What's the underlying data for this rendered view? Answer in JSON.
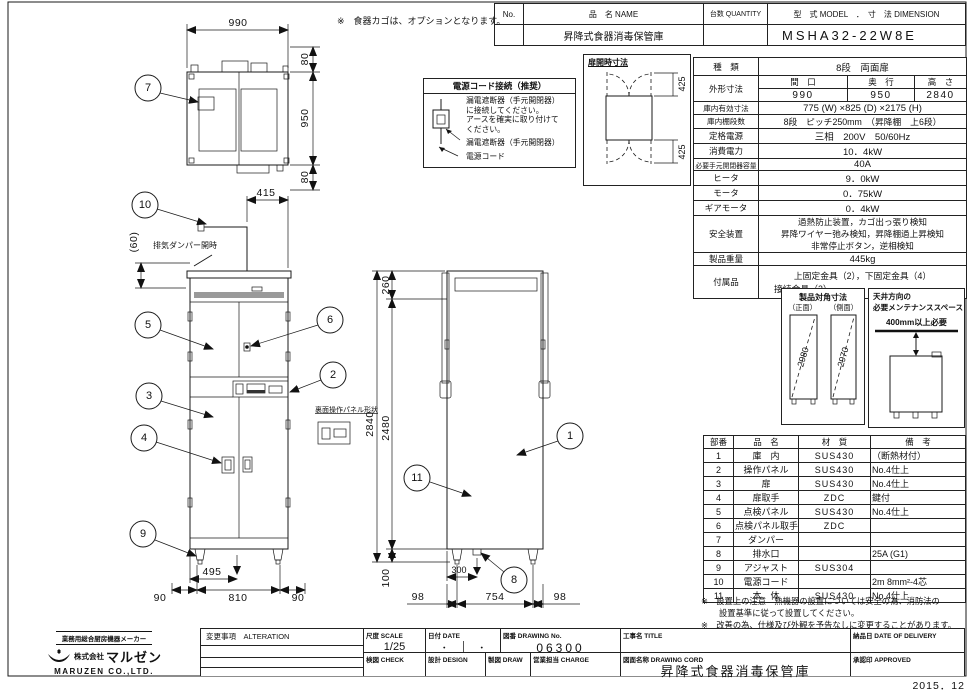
{
  "sheet": {
    "date_stamp": "2015．12"
  },
  "title_table": {
    "no_label": "No.",
    "name_label": "品　名 NAME",
    "qty_label": "台数 QUANTITY",
    "model_label": "型　式 MODEL　．　寸　法 DIMENSION",
    "product_name": "昇降式食器消毒保管庫",
    "model_value": "MSHA32-22W8E"
  },
  "option_note": "※　食器カゴは、オプションとなります。",
  "spec": {
    "kind_label": "種　類",
    "kind_value": "8段　両面扉",
    "outer_label": "外形寸法",
    "width_label": "間　口",
    "depth_label": "奥　行",
    "height_label": "高　さ",
    "width_value": "990",
    "depth_value": "950",
    "height_value": "2840",
    "inner_label": "庫内有効寸法",
    "inner_value": "775 (W) ×825 (D) ×2175 (H)",
    "shelf_label": "庫内棚段数",
    "shelf_value": "8段　ピッチ250mm　（昇降棚　上6段）",
    "power_label": "定格電源",
    "power_value": "三相　200V　50/60Hz",
    "consumption_label": "消費電力",
    "consumption_value": "10．4kW",
    "breaker_label": "必要手元開閉器容量",
    "breaker_value": "40A",
    "heater_label": "ヒータ",
    "heater_value": "9．0kW",
    "motor_label": "モータ",
    "motor_value": "0．75kW",
    "gear_label": "ギアモータ",
    "gear_value": "0．4kW",
    "safety_label": "安全装置",
    "safety_line1": "過熱防止装置，カゴ出っ張り検知",
    "safety_line2": "昇降ワイヤー弛み検知，昇降棚過上昇検知",
    "safety_line3": "非常停止ボタン，逆相検知",
    "weight_label": "製品重量",
    "weight_value": "445kg",
    "accessory_label": "付属品",
    "accessory_line1": "上固定金具（2），下固定金具（4）",
    "accessory_line2": "接続金具（2）"
  },
  "diagonal_box": {
    "title": "製品対角寸法",
    "front_label": "（正面）",
    "side_label": "（側面）",
    "front_value": "2980",
    "side_value": "2970"
  },
  "maintenance_box": {
    "title_line1": "天井方向の",
    "title_line2": "必要メンテナンススペース",
    "clearance": "400mm以上必要"
  },
  "parts": {
    "headers": {
      "no": "部番",
      "name": "品　名",
      "material": "材　質",
      "note": "備　考"
    },
    "rows": [
      {
        "no": "1",
        "name": "庫　内",
        "material": "SUS430",
        "note": "（断熱材付）"
      },
      {
        "no": "2",
        "name": "操作パネル",
        "material": "SUS430",
        "note": "No.4仕上"
      },
      {
        "no": "3",
        "name": "扉",
        "material": "SUS430",
        "note": "No.4仕上"
      },
      {
        "no": "4",
        "name": "扉取手",
        "material": "ZDC",
        "note": "鍵付"
      },
      {
        "no": "5",
        "name": "点検パネル",
        "material": "SUS430",
        "note": "No.4仕上"
      },
      {
        "no": "6",
        "name": "点検パネル取手",
        "material": "ZDC",
        "note": ""
      },
      {
        "no": "7",
        "name": "ダンパー",
        "material": "",
        "note": ""
      },
      {
        "no": "8",
        "name": "排水口",
        "material": "",
        "note": "25A (G1)"
      },
      {
        "no": "9",
        "name": "アジャスト",
        "material": "SUS304",
        "note": ""
      },
      {
        "no": "10",
        "name": "電源コード",
        "material": "",
        "note": "2m 8mm²-4芯"
      },
      {
        "no": "11",
        "name": "本　体",
        "material": "SUS430",
        "note": "No.4仕上"
      }
    ]
  },
  "footnotes": {
    "line1": "※　設置上の注意　熱機器の設置については安全の為、消防法の",
    "line2": "設置基準に従って設置してください。",
    "line3": "※　改善の為、仕様及び外観を予告なしに変更することがあります。"
  },
  "power_box": {
    "title": "電源コード接続（推奨）",
    "instruction_line1": "漏電遮断器（手元開閉器）",
    "instruction_line2": "に接続してください。",
    "instruction_line3": "アースを確実に取り付けて",
    "instruction_line4": "ください。",
    "breaker_label": "漏電遮断器（手元開閉器）",
    "cord_label": "電源コード"
  },
  "door_box": {
    "title": "扉開時寸法"
  },
  "labels": {
    "damper_note": "排気ダンパー開時",
    "rear_panel_note": "裏面操作パネル形状"
  },
  "dims": {
    "top_width": "990",
    "top_m1": "80",
    "top_depth": "950",
    "top_m2": "80",
    "f_cord": "415",
    "f_damper": "(60)",
    "f_drain": "495",
    "f_m1": "90",
    "f_body": "810",
    "f_m2": "90",
    "s_vent": "260",
    "s_total": "2840",
    "s_inner": "2480",
    "s_base": "100",
    "s_drain": "300",
    "s_m1": "98",
    "s_body": "754",
    "s_m2": "98",
    "door_top": "425",
    "door_bottom": "425"
  },
  "callouts": {
    "c1": "1",
    "c2": "2",
    "c3": "3",
    "c4": "4",
    "c5": "5",
    "c6": "6",
    "c7": "7",
    "c8": "8",
    "c9": "9",
    "c10": "10",
    "c11": "11"
  },
  "title_block": {
    "maker_tagline": "業務用総合厨房機器メーカー",
    "company_prefix": "株式会社",
    "company_logo_text": "マルゼン",
    "company_en": "MARUZEN CO.,LTD.",
    "alteration_label": "変更事項　ALTERATION",
    "scale_label": "尺度 SCALE",
    "scale_value": "1/25",
    "date_label": "日付 DATE",
    "date_value1": "・",
    "date_value2": "・",
    "drawing_no_label": "図番 DRAWING No.",
    "drawing_no_value": "06300",
    "project_label": "工事名 TITLE",
    "check_label": "検図 CHECK",
    "design_label": "設計 DESIGN",
    "draw_label": "製図 DRAW",
    "charge_label": "営業担当 CHARGE",
    "drawing_name_label": "図面名称 DRAWING CORD",
    "drawing_name_value": "昇降式食器消毒保管庫",
    "delivery_label": "納品日 DATE OF DELIVERY",
    "approved_label": "承認印 APPROVED"
  }
}
